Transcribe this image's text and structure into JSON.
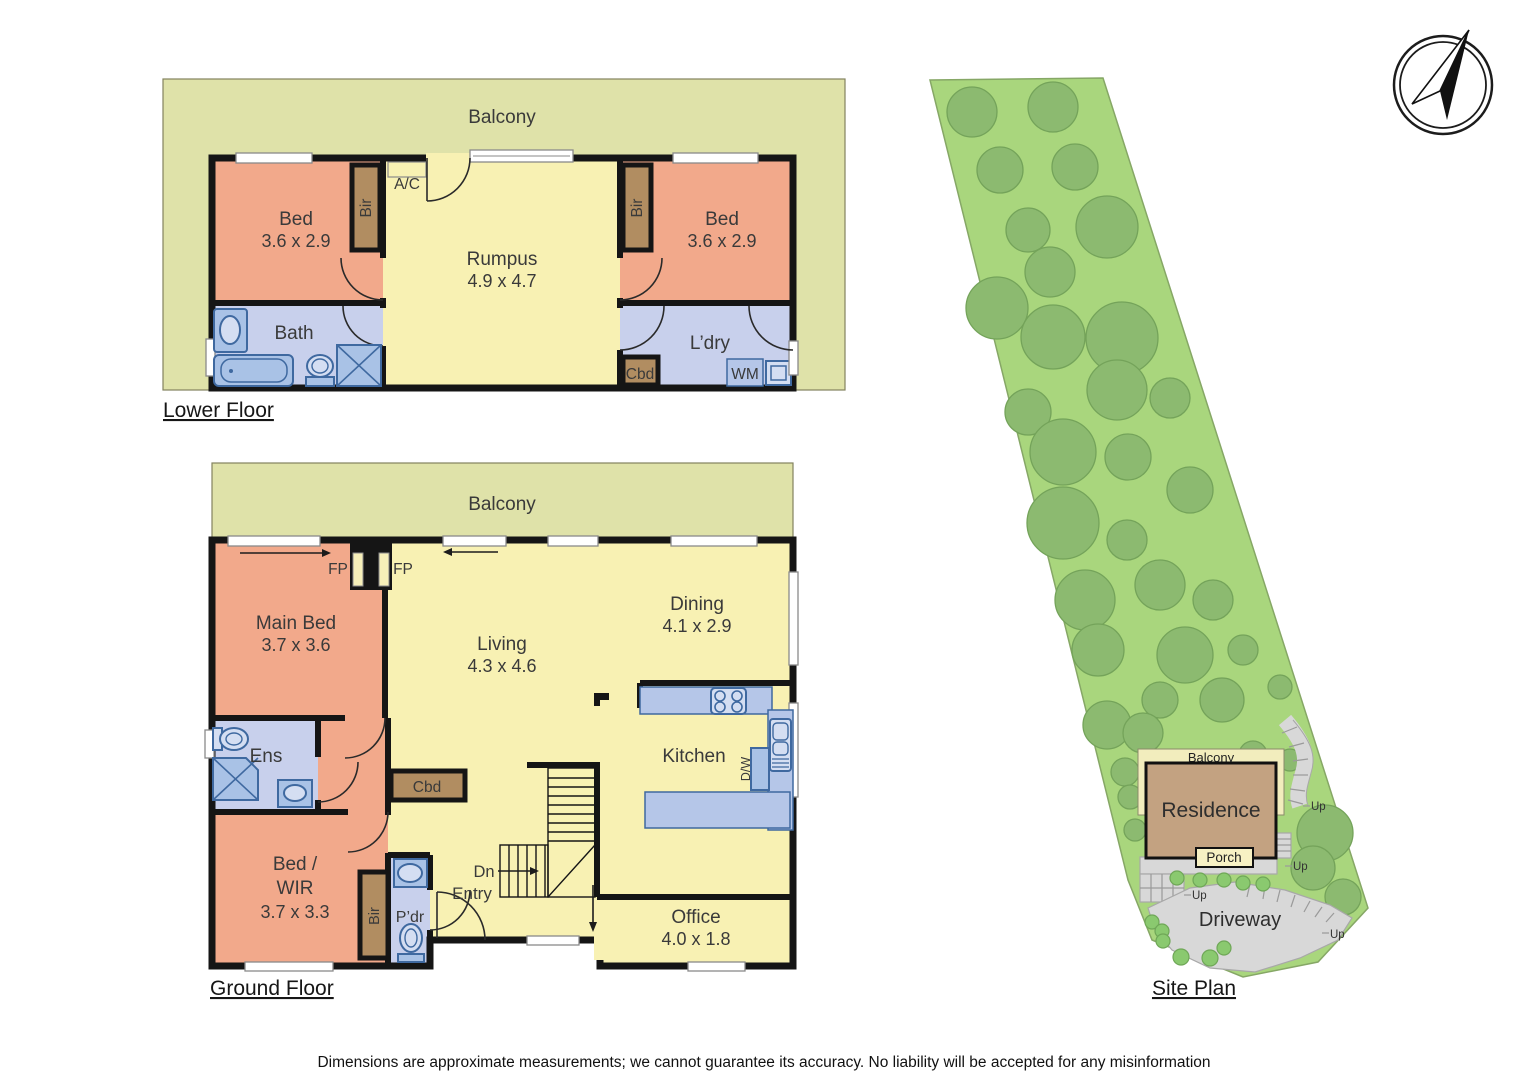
{
  "page": {
    "disclaimer": "Dimensions are approximate measurements; we cannot guarantee its accuracy. No liability will be accepted for any misinformation"
  },
  "lower_floor": {
    "title": "Lower Floor",
    "balcony": "Balcony",
    "bed_left_name": "Bed",
    "bed_left_dims": "3.6 x 2.9",
    "bir_left": "Bir",
    "ac": "A/C",
    "rumpus_name": "Rumpus",
    "rumpus_dims": "4.9 x 4.7",
    "bir_right": "Bir",
    "bed_right_name": "Bed",
    "bed_right_dims": "3.6 x 2.9",
    "bath": "Bath",
    "ldry": "L’dry",
    "cbd": "Cbd",
    "wm": "WM"
  },
  "ground_floor": {
    "title": "Ground Floor",
    "balcony": "Balcony",
    "fp_left": "FP",
    "fp_right": "FP",
    "main_bed_name": "Main Bed",
    "main_bed_dims": "3.7 x 3.6",
    "living_name": "Living",
    "living_dims": "4.3 x 4.6",
    "dining_name": "Dining",
    "dining_dims": "4.1 x 2.9",
    "kitchen": "Kitchen",
    "dw": "D/W",
    "ens": "Ens",
    "cbd": "Cbd",
    "bed_wir_line1": "Bed /",
    "bed_wir_line2": "WIR",
    "bed_wir_dims": "3.7 x 3.3",
    "bir": "Bir",
    "pdr": "P’dr",
    "dn": "Dn",
    "entry": "Entry",
    "office_name": "Office",
    "office_dims": "4.0 x 1.8"
  },
  "site_plan": {
    "title": "Site Plan",
    "balcony": "Balcony",
    "residence": "Residence",
    "porch": "Porch",
    "driveway": "Driveway",
    "up_top": "Up",
    "up_right": "Up",
    "up_left": "Up",
    "up_drive": "Up"
  },
  "colors": {
    "balcony_band": "#dfe2a9",
    "room_yellow": "#f8f1b3",
    "room_salmon": "#f2a98b",
    "room_blue": "#c8d0ec",
    "joinery_brown": "#b18d61",
    "fixture_blue": "#a9c2e6",
    "site_green": "#a9d67d",
    "tree_green": "#8cba70",
    "paving_gray": "#d8d8d8",
    "residence_tan": "#c3a281",
    "wall_black": "#151515"
  }
}
